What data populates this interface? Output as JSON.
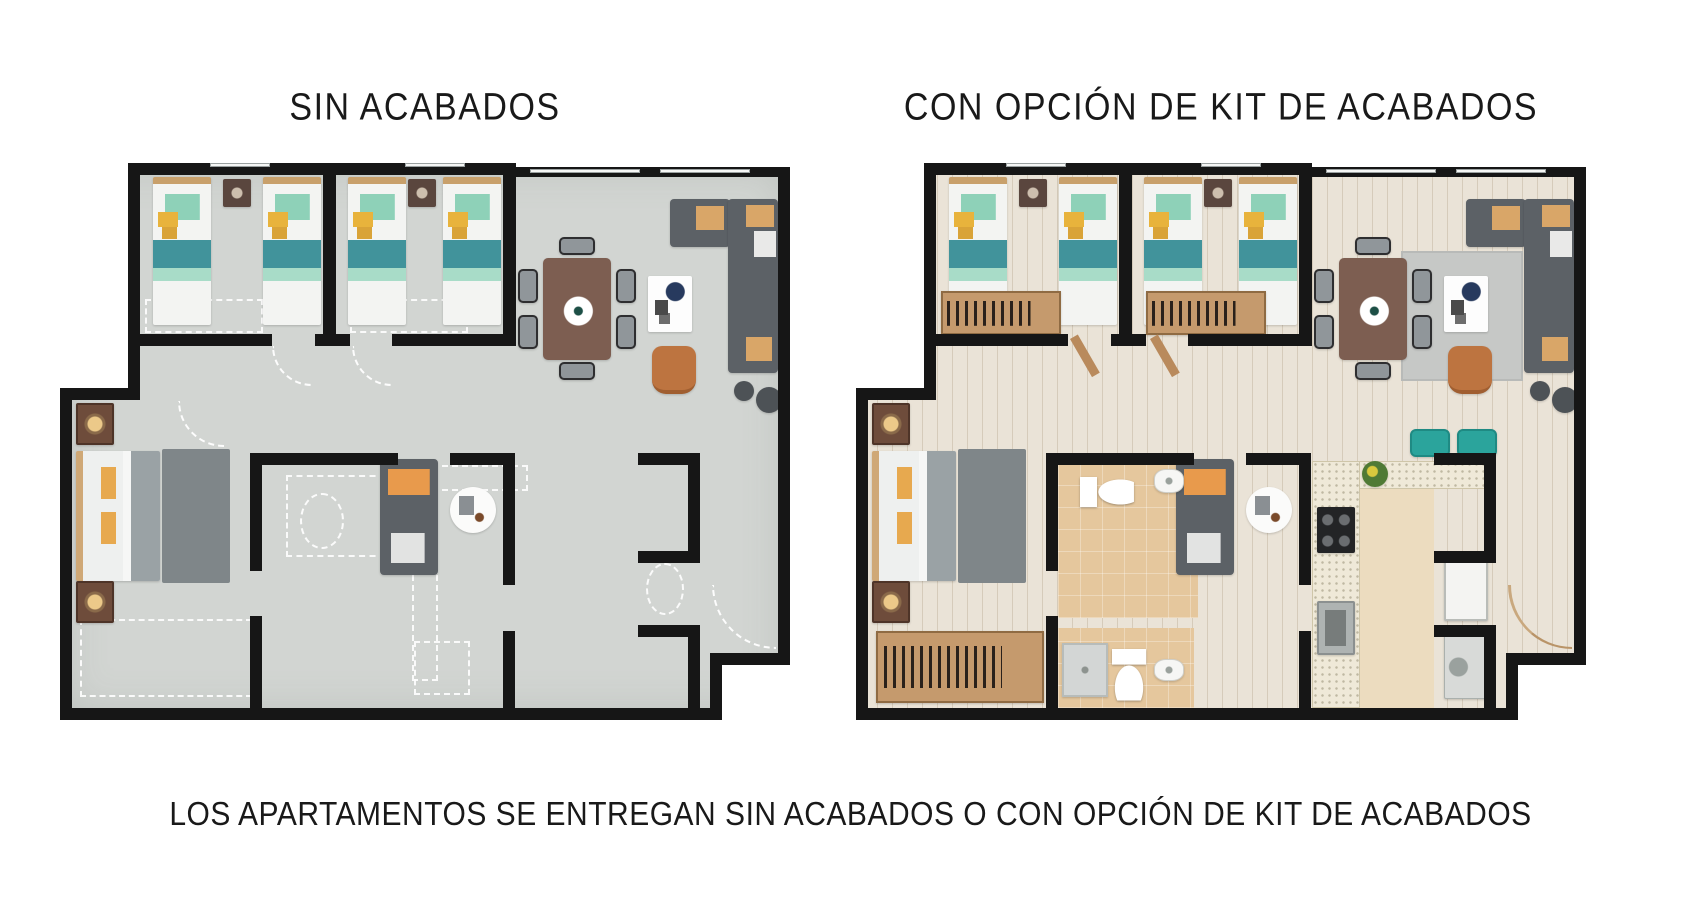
{
  "titles": {
    "left": "SIN ACABADOS",
    "right": "CON OPCIÓN DE KIT DE ACABADOS"
  },
  "caption": "LOS APARTAMENTOS SE ENTREGAN SIN ACABADOS O CON OPCIÓN DE KIT DE ACABADOS",
  "colors": {
    "wall": "#161616",
    "concrete_floor": "#d2d5d2",
    "wood_floor": "#eae3d7",
    "tile_floor": "#e5c79d",
    "kitchen_floor": "#ecdcbf",
    "counter_granite": "#efe9d8",
    "sofa_gray": "#5c6166",
    "accent_orange": "#e89a4c",
    "accent_teal": "#8ed1b8",
    "accent_yellow": "#e8b33c",
    "stool_teal": "#2ba49c",
    "table_brown": "#7d5e51"
  },
  "shared": {
    "width": 730,
    "height": 557,
    "walls": [
      [
        68,
        0,
        388,
        12
      ],
      [
        443,
        4,
        287,
        10
      ],
      [
        718,
        4,
        12,
        498
      ],
      [
        650,
        490,
        80,
        12
      ],
      [
        650,
        490,
        12,
        67
      ],
      [
        0,
        545,
        662,
        12
      ],
      [
        0,
        225,
        12,
        332
      ],
      [
        68,
        0,
        12,
        237
      ],
      [
        0,
        225,
        80,
        12
      ],
      [
        263,
        0,
        13,
        183
      ],
      [
        443,
        0,
        13,
        183
      ],
      [
        80,
        171,
        132,
        12
      ],
      [
        255,
        171,
        35,
        12
      ],
      [
        332,
        171,
        111,
        12
      ],
      [
        190,
        290,
        12,
        118
      ],
      [
        190,
        453,
        12,
        92
      ],
      [
        190,
        290,
        148,
        12
      ],
      [
        390,
        290,
        65,
        12
      ],
      [
        443,
        290,
        12,
        132
      ],
      [
        443,
        468,
        12,
        77
      ],
      [
        578,
        290,
        62,
        12
      ],
      [
        628,
        290,
        12,
        110
      ],
      [
        578,
        388,
        52,
        12
      ],
      [
        578,
        462,
        62,
        12
      ],
      [
        628,
        462,
        12,
        83
      ]
    ],
    "voids": [
      [
        0,
        0,
        68,
        225
      ],
      [
        662,
        502,
        68,
        55
      ]
    ],
    "windows": [
      [
        470,
        6,
        110,
        4
      ],
      [
        600,
        6,
        90,
        4
      ],
      [
        150,
        0,
        60,
        4
      ],
      [
        345,
        0,
        60,
        4
      ]
    ]
  },
  "plans": [
    {
      "id": "sin",
      "name": "plan-sin-acabados",
      "origin": {
        "x": 60,
        "y": 163
      },
      "floors": [
        {
          "style": "concrete",
          "n": "concrete-floor",
          "x": 6,
          "y": 4,
          "w": 718,
          "h": 545
        }
      ],
      "dashes": [
        {
          "n": "closet-outline-1",
          "x": 85,
          "y": 136,
          "w": 118,
          "h": 34
        },
        {
          "n": "closet-outline-2",
          "x": 290,
          "y": 136,
          "w": 118,
          "h": 34
        },
        {
          "n": "master-closet-outline",
          "x": 20,
          "y": 456,
          "w": 172,
          "h": 78
        },
        {
          "n": "bathroom-outline",
          "x": 226,
          "y": 312,
          "w": 100,
          "h": 82
        },
        {
          "n": "toilet-outline",
          "x": 240,
          "y": 330,
          "w": 44,
          "h": 56,
          "round": true
        },
        {
          "n": "kitchen-counter-outline-h",
          "x": 352,
          "y": 302,
          "w": 116,
          "h": 26
        },
        {
          "n": "kitchen-counter-outline-v",
          "x": 352,
          "y": 302,
          "w": 26,
          "h": 216
        },
        {
          "n": "appliance-outline",
          "x": 354,
          "y": 478,
          "w": 56,
          "h": 54
        },
        {
          "n": "nook-toilet-outline",
          "x": 586,
          "y": 400,
          "w": 38,
          "h": 52,
          "round": true
        }
      ],
      "furniture": [
        {
          "t": "twin-bed",
          "n": "twin-bed-1",
          "x": 93,
          "y": 14,
          "w": 58,
          "h": 148
        },
        {
          "t": "twin-bed",
          "n": "twin-bed-2",
          "x": 203,
          "y": 14,
          "w": 58,
          "h": 148
        },
        {
          "t": "twin-bed",
          "n": "twin-bed-3",
          "x": 288,
          "y": 14,
          "w": 58,
          "h": 148
        },
        {
          "t": "twin-bed",
          "n": "twin-bed-4",
          "x": 383,
          "y": 14,
          "w": 58,
          "h": 148
        },
        {
          "t": "wall-art",
          "n": "wall-art-1",
          "x": 163,
          "y": 16,
          "w": 28,
          "h": 28
        },
        {
          "t": "wall-art",
          "n": "wall-art-2",
          "x": 348,
          "y": 16,
          "w": 28,
          "h": 28
        },
        {
          "t": "dining-table",
          "n": "dining-table",
          "x": 483,
          "y": 95,
          "w": 68,
          "h": 102
        },
        {
          "t": "chair",
          "n": "dining-chair-1",
          "x": 458,
          "y": 106,
          "w": 20,
          "h": 34
        },
        {
          "t": "chair",
          "n": "dining-chair-2",
          "x": 458,
          "y": 152,
          "w": 20,
          "h": 34
        },
        {
          "t": "chair",
          "n": "dining-chair-3",
          "x": 556,
          "y": 106,
          "w": 20,
          "h": 34
        },
        {
          "t": "chair",
          "n": "dining-chair-4",
          "x": 556,
          "y": 152,
          "w": 20,
          "h": 34
        },
        {
          "t": "chair",
          "n": "dining-chair-5",
          "x": 499,
          "y": 74,
          "w": 36,
          "h": 18
        },
        {
          "t": "chair",
          "n": "dining-chair-6",
          "x": 499,
          "y": 199,
          "w": 36,
          "h": 18
        },
        {
          "t": "coffee-table",
          "n": "coffee-table",
          "x": 588,
          "y": 113,
          "w": 44,
          "h": 56
        },
        {
          "t": "armchair",
          "n": "armchair",
          "x": 592,
          "y": 183,
          "w": 44,
          "h": 48
        },
        {
          "t": "sofa-h",
          "n": "sectional-sofa-top",
          "x": 610,
          "y": 36,
          "w": 60,
          "h": 48
        },
        {
          "t": "sofa-v",
          "n": "sectional-sofa-side",
          "x": 668,
          "y": 36,
          "w": 50,
          "h": 174
        },
        {
          "t": "dot",
          "n": "side-table-small",
          "x": 674,
          "y": 218,
          "w": 20,
          "h": 20
        },
        {
          "t": "dot",
          "n": "side-table-large",
          "x": 696,
          "y": 224,
          "w": 26,
          "h": 26
        },
        {
          "t": "loveseat",
          "n": "loveseat",
          "x": 320,
          "y": 296,
          "w": 58,
          "h": 116
        },
        {
          "t": "round-table",
          "n": "round-side-table",
          "x": 390,
          "y": 324,
          "w": 46,
          "h": 46
        },
        {
          "t": "double-bed",
          "n": "master-bed",
          "x": 16,
          "y": 288,
          "w": 84,
          "h": 130
        },
        {
          "t": "rug",
          "n": "master-rug",
          "x": 102,
          "y": 286,
          "w": 68,
          "h": 134
        },
        {
          "t": "nightstand",
          "n": "nightstand-1",
          "x": 16,
          "y": 240,
          "w": 38,
          "h": 42
        },
        {
          "t": "nightstand",
          "n": "nightstand-2",
          "x": 16,
          "y": 418,
          "w": 38,
          "h": 42
        },
        {
          "t": "arc",
          "n": "entry-door-swing",
          "x": 652,
          "y": 422,
          "w": 64,
          "h": 64
        },
        {
          "t": "arc",
          "n": "bedroom-door-swing-1",
          "x": 212,
          "y": 183,
          "w": 40,
          "h": 40
        },
        {
          "t": "arc",
          "n": "bedroom-door-swing-2",
          "x": 292,
          "y": 183,
          "w": 40,
          "h": 40
        },
        {
          "t": "arc",
          "n": "master-door-swing",
          "x": 118,
          "y": 238,
          "w": 46,
          "h": 46
        }
      ]
    },
    {
      "id": "kit",
      "name": "plan-kit-acabados",
      "origin": {
        "x": 856,
        "y": 163
      },
      "floors": [
        {
          "style": "wood",
          "n": "wood-floor",
          "x": 6,
          "y": 4,
          "w": 718,
          "h": 545
        },
        {
          "style": "tile",
          "n": "bathroom-floor-1",
          "x": 202,
          "y": 302,
          "w": 140,
          "h": 153
        },
        {
          "style": "tile",
          "n": "bathroom-floor-2",
          "x": 202,
          "y": 465,
          "w": 136,
          "h": 80
        },
        {
          "style": "kitchen",
          "n": "kitchen-floor",
          "x": 456,
          "y": 298,
          "w": 122,
          "h": 247
        },
        {
          "style": "ruglight",
          "n": "living-rug",
          "x": 545,
          "y": 88,
          "w": 122,
          "h": 130
        }
      ],
      "dashes": [],
      "furniture": [
        {
          "t": "twin-bed",
          "n": "twin-bed-1",
          "x": 93,
          "y": 14,
          "w": 58,
          "h": 148
        },
        {
          "t": "twin-bed",
          "n": "twin-bed-2",
          "x": 203,
          "y": 14,
          "w": 58,
          "h": 148
        },
        {
          "t": "twin-bed",
          "n": "twin-bed-3",
          "x": 288,
          "y": 14,
          "w": 58,
          "h": 148
        },
        {
          "t": "twin-bed",
          "n": "twin-bed-4",
          "x": 383,
          "y": 14,
          "w": 58,
          "h": 148
        },
        {
          "t": "wall-art",
          "n": "wall-art-1",
          "x": 163,
          "y": 16,
          "w": 28,
          "h": 28
        },
        {
          "t": "wall-art",
          "n": "wall-art-2",
          "x": 348,
          "y": 16,
          "w": 28,
          "h": 28
        },
        {
          "t": "wardrobe",
          "n": "bedroom-wardrobe-1",
          "x": 85,
          "y": 128,
          "w": 120,
          "h": 44
        },
        {
          "t": "wardrobe",
          "n": "bedroom-wardrobe-2",
          "x": 290,
          "y": 128,
          "w": 120,
          "h": 44
        },
        {
          "t": "dining-table",
          "n": "dining-table",
          "x": 483,
          "y": 95,
          "w": 68,
          "h": 102
        },
        {
          "t": "chair",
          "n": "dining-chair-1",
          "x": 458,
          "y": 106,
          "w": 20,
          "h": 34
        },
        {
          "t": "chair",
          "n": "dining-chair-2",
          "x": 458,
          "y": 152,
          "w": 20,
          "h": 34
        },
        {
          "t": "chair",
          "n": "dining-chair-3",
          "x": 556,
          "y": 106,
          "w": 20,
          "h": 34
        },
        {
          "t": "chair",
          "n": "dining-chair-4",
          "x": 556,
          "y": 152,
          "w": 20,
          "h": 34
        },
        {
          "t": "chair",
          "n": "dining-chair-5",
          "x": 499,
          "y": 74,
          "w": 36,
          "h": 18
        },
        {
          "t": "chair",
          "n": "dining-chair-6",
          "x": 499,
          "y": 199,
          "w": 36,
          "h": 18
        },
        {
          "t": "coffee-table",
          "n": "coffee-table",
          "x": 588,
          "y": 113,
          "w": 44,
          "h": 56
        },
        {
          "t": "armchair",
          "n": "armchair",
          "x": 592,
          "y": 183,
          "w": 44,
          "h": 48
        },
        {
          "t": "sofa-h",
          "n": "sectional-sofa-top",
          "x": 610,
          "y": 36,
          "w": 60,
          "h": 48
        },
        {
          "t": "sofa-v",
          "n": "sectional-sofa-side",
          "x": 668,
          "y": 36,
          "w": 50,
          "h": 174
        },
        {
          "t": "dot",
          "n": "side-table-small",
          "x": 674,
          "y": 218,
          "w": 20,
          "h": 20
        },
        {
          "t": "dot",
          "n": "side-table-large",
          "x": 696,
          "y": 224,
          "w": 26,
          "h": 26
        },
        {
          "t": "loveseat",
          "n": "loveseat",
          "x": 320,
          "y": 296,
          "w": 58,
          "h": 116
        },
        {
          "t": "round-table",
          "n": "round-side-table",
          "x": 390,
          "y": 324,
          "w": 46,
          "h": 46
        },
        {
          "t": "double-bed",
          "n": "master-bed",
          "x": 16,
          "y": 288,
          "w": 84,
          "h": 130
        },
        {
          "t": "rug",
          "n": "master-rug",
          "x": 102,
          "y": 286,
          "w": 68,
          "h": 134
        },
        {
          "t": "nightstand",
          "n": "nightstand-1",
          "x": 16,
          "y": 240,
          "w": 38,
          "h": 42
        },
        {
          "t": "nightstand",
          "n": "nightstand-2",
          "x": 16,
          "y": 418,
          "w": 38,
          "h": 42
        },
        {
          "t": "wardrobe",
          "n": "master-wardrobe",
          "x": 20,
          "y": 468,
          "w": 168,
          "h": 72
        },
        {
          "t": "counter",
          "n": "kitchen-counter-top",
          "x": 456,
          "y": 298,
          "w": 184,
          "h": 28
        },
        {
          "t": "counter",
          "n": "kitchen-counter-side",
          "x": 456,
          "y": 298,
          "w": 48,
          "h": 247
        },
        {
          "t": "stove",
          "n": "stove",
          "x": 461,
          "y": 344,
          "w": 38,
          "h": 46
        },
        {
          "t": "ksink",
          "n": "kitchen-sink",
          "x": 461,
          "y": 438,
          "w": 38,
          "h": 54
        },
        {
          "t": "plant",
          "n": "counter-plant",
          "x": 506,
          "y": 298,
          "w": 26,
          "h": 26
        },
        {
          "t": "stool",
          "n": "bar-stool-1",
          "x": 554,
          "y": 266,
          "w": 40,
          "h": 28
        },
        {
          "t": "stool",
          "n": "bar-stool-2",
          "x": 601,
          "y": 266,
          "w": 40,
          "h": 28
        },
        {
          "t": "fridge",
          "n": "fridge",
          "x": 588,
          "y": 396,
          "w": 44,
          "h": 62
        },
        {
          "t": "washer",
          "n": "washing-machine",
          "x": 588,
          "y": 472,
          "w": 44,
          "h": 64
        },
        {
          "t": "toilet-h",
          "n": "toilet-1",
          "x": 224,
          "y": 314,
          "w": 54,
          "h": 30
        },
        {
          "t": "bsink",
          "n": "bathroom-sink-1",
          "x": 298,
          "y": 306,
          "w": 30,
          "h": 24
        },
        {
          "t": "shower",
          "n": "shower",
          "x": 206,
          "y": 480,
          "w": 46,
          "h": 54
        },
        {
          "t": "toilet-v",
          "n": "toilet-2",
          "x": 256,
          "y": 486,
          "w": 34,
          "h": 52
        },
        {
          "t": "bsink",
          "n": "bathroom-sink-2",
          "x": 298,
          "y": 496,
          "w": 30,
          "h": 22
        },
        {
          "t": "arc-wood",
          "n": "entry-door-swing",
          "x": 652,
          "y": 422,
          "w": 64,
          "h": 64
        },
        {
          "t": "door",
          "n": "bedroom-door-leaf-1",
          "x": 214,
          "y": 176,
          "w": 9,
          "h": 44,
          "r": -30
        },
        {
          "t": "door",
          "n": "bedroom-door-leaf-2",
          "x": 294,
          "y": 176,
          "w": 9,
          "h": 44,
          "r": -30
        }
      ]
    }
  ]
}
